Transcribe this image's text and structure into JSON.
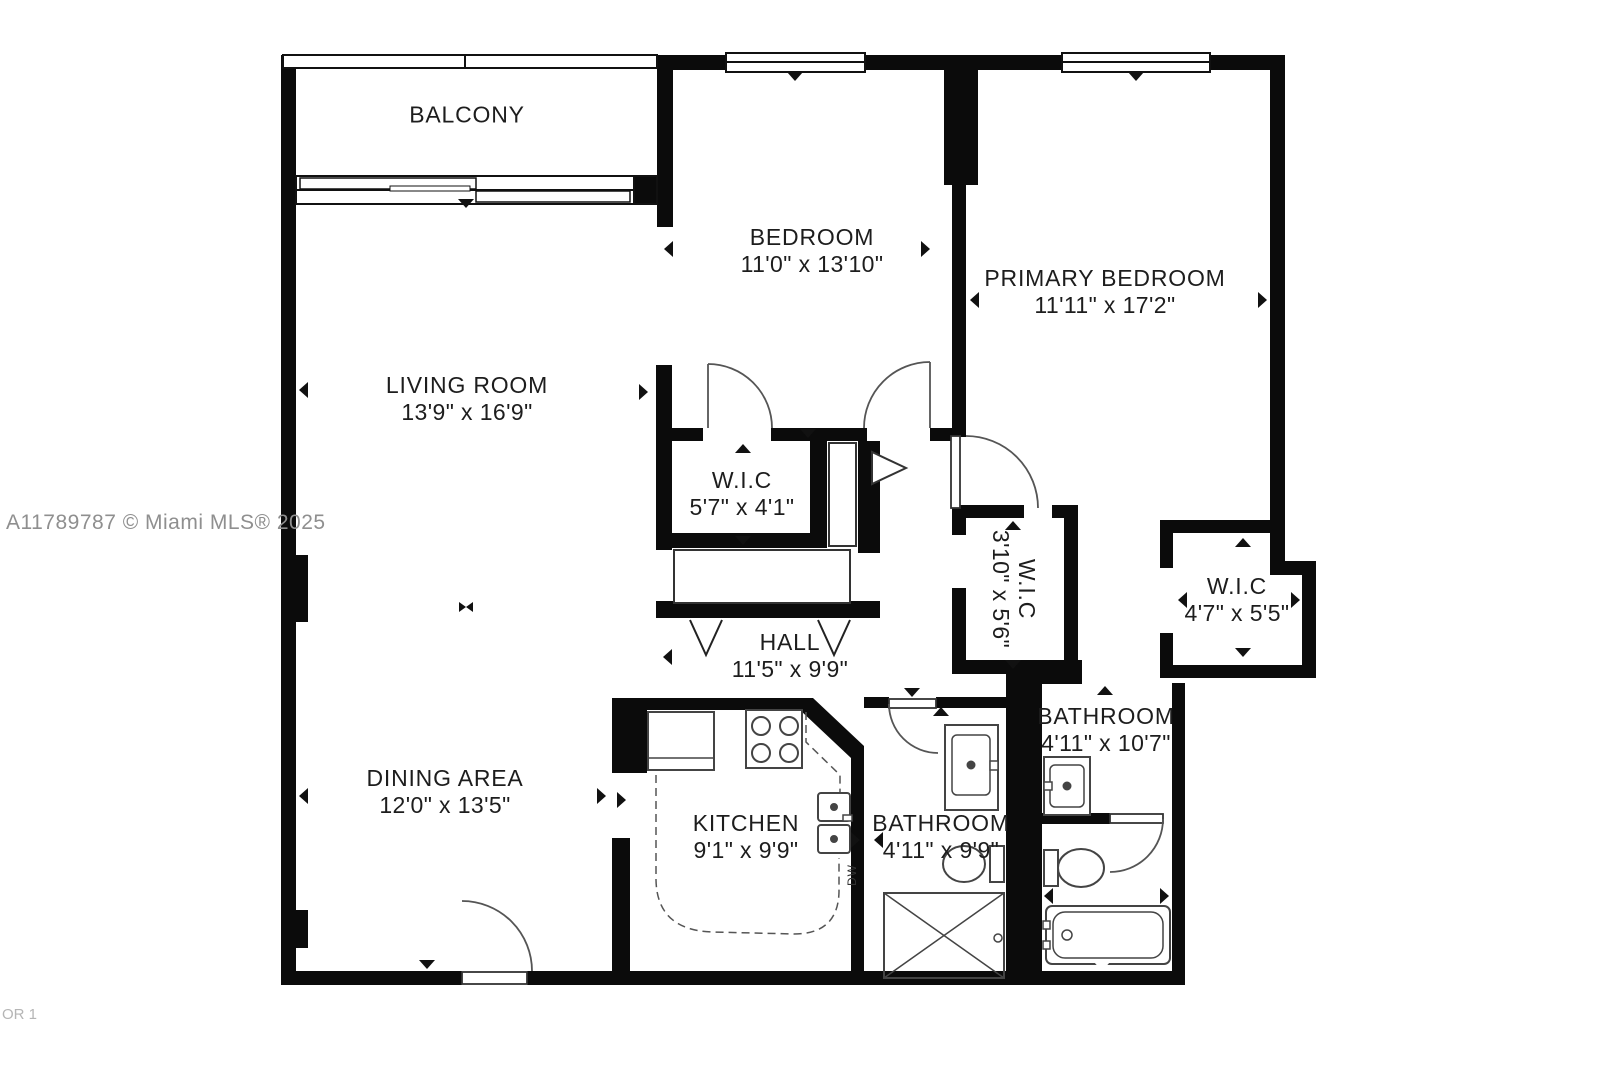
{
  "watermark": "A11789787 © Miami MLS® 2025",
  "floor_label": "OR 1",
  "rooms": {
    "balcony": {
      "name": "BALCONY",
      "dims": ""
    },
    "living_room": {
      "name": "LIVING ROOM",
      "dims": "13'9\" x 16'9\""
    },
    "dining_area": {
      "name": "DINING AREA",
      "dims": "12'0\" x 13'5\""
    },
    "bedroom": {
      "name": "BEDROOM",
      "dims": "11'0\" x 13'10\""
    },
    "primary_bedroom": {
      "name": "PRIMARY BEDROOM",
      "dims": "11'11\" x 17'2\""
    },
    "wic_hall": {
      "name": "W.I.C",
      "dims": "5'7\" x 4'1\""
    },
    "hall": {
      "name": "HALL",
      "dims": "11'5\" x 9'9\""
    },
    "wic_center": {
      "name": "W.I.C",
      "dims": "3'10\" x 5'6\""
    },
    "wic_right": {
      "name": "W.I.C",
      "dims": "4'7\" x 5'5\""
    },
    "kitchen": {
      "name": "KITCHEN",
      "dims": "9'1\" x 9'9\""
    },
    "bathroom_hall": {
      "name": "BATHROOM",
      "dims": "4'11\" x 9'9\""
    },
    "bathroom_primary": {
      "name": "BATHROOM",
      "dims": "4'11\" x 10'7\""
    }
  },
  "fixtures": {
    "dishwasher": "DW"
  },
  "colors": {
    "wall": "#0b0b0b",
    "fixture_line": "#444444",
    "watermark": "#8f8f8f"
  }
}
